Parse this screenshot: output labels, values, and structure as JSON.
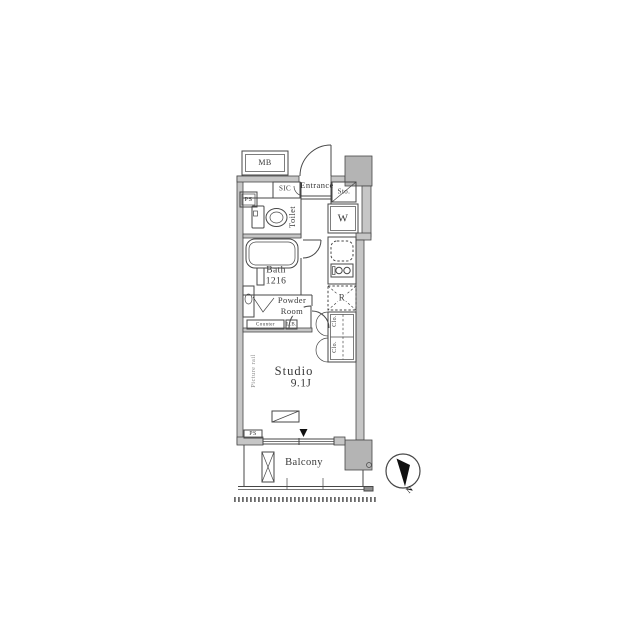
{
  "plan": {
    "labels": {
      "mb": "MB",
      "ps_top": "PS",
      "sic": "SIC",
      "entrance": "Entrance",
      "sto": "Sto.",
      "washer": "W",
      "toilet": "Toilet",
      "bath_name": "Bath",
      "bath_size": "1216",
      "powder_line1": "Powder",
      "powder_line2": "Room",
      "counter": "Counter",
      "lavatory_box": "L.B.",
      "fridge": "R",
      "closet_upper": "Clo.",
      "closet_lower": "Clo.",
      "studio_name": "Studio",
      "studio_size": "9.1J",
      "picture_rail": "Picture rail",
      "ps_bottom": "PS",
      "balcony": "Balcony",
      "north": "N"
    },
    "colors": {
      "wall_fill": "#c6c6c6",
      "column_fill": "#b4b4b4",
      "line": "#474747",
      "text": "#383838",
      "muted_text": "#8a8a8a",
      "black": "#101010"
    }
  }
}
